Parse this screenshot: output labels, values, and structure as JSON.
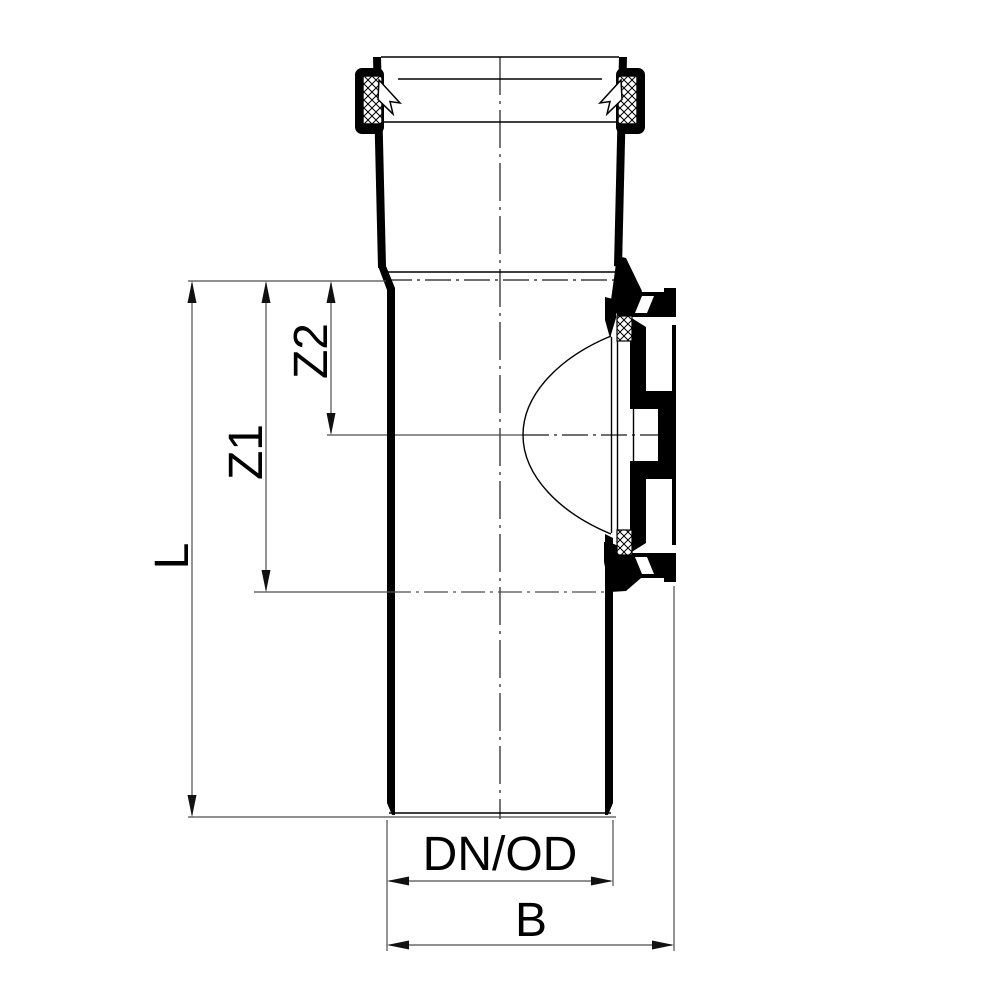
{
  "drawing": {
    "kind": "pipe-fitting-cross-section",
    "colors": {
      "background": "#ffffff",
      "ink": "#000000",
      "dimension_lines": "#4d4d4d"
    },
    "labels": {
      "length": "L",
      "z1": "Z1",
      "z2": "Z2",
      "diameter": "DN/OD",
      "width": "B"
    }
  }
}
